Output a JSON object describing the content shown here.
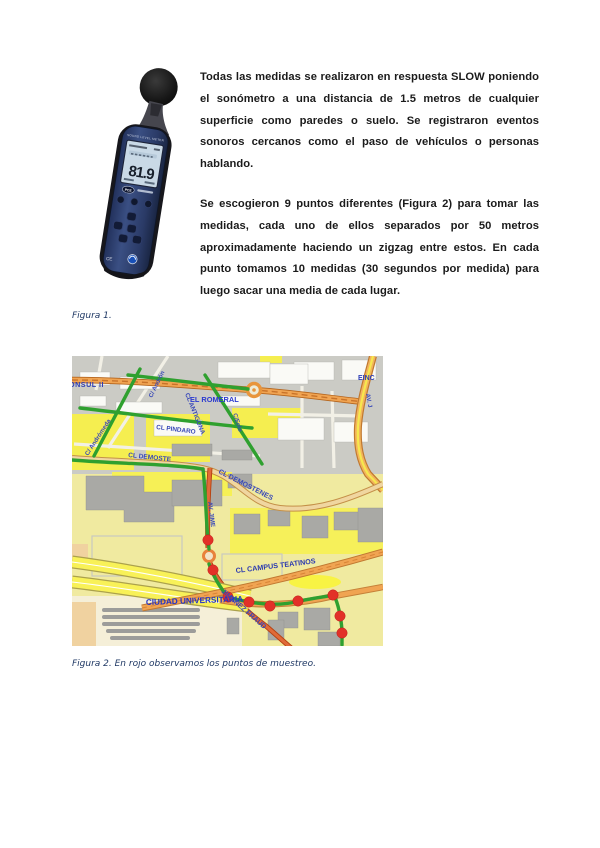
{
  "document": {
    "paragraph1": "Todas las medidas se realizaron en respuesta SLOW poniendo el sonómetro a una distancia de 1.5 metros de cualquier superficie como paredes o suelo. Se registraron eventos sonoros cercanos como el paso de vehículos o personas hablando.",
    "paragraph2": "Se escogieron 9 puntos diferentes (Figura 2) para tomar las medidas, cada uno de ellos separados por 50 metros aproximadamente haciendo un zigzag entre estos. En cada punto tomamos 10 medidas (30 segundos por medida) para luego sacar una media de cada lugar.",
    "figure1_caption": "Figura 1.",
    "figure2_caption": "Figura 2. En rojo observamos los puntos de muestreo."
  },
  "meter": {
    "header_label": "SOUND LEVEL METER",
    "display_value": "81.9",
    "brand_logo": "PCE",
    "ce_mark": "CE"
  },
  "map": {
    "street_labels": {
      "consul": "ONSUL II",
      "andron": "C/ Andrón",
      "andromeda": "C/ Andrómeda",
      "pindaro": "CL PINDARO",
      "antigona": "CL ANTIGONA",
      "romeral": "EL ROMERAL",
      "eolo": "C/Eolo",
      "einc": "EINC",
      "av_j": "AV. J",
      "demoste": "CL DEMOSTE",
      "demostenes": "CL DEMOSTENES",
      "av_jime": "AV. JIME",
      "campus_teatinos": "CL CAMPUS TEATINOS",
      "ciudad_universitaria": "CIUDAD UNIVERSITARIA",
      "jimenez_fraud": "JIMENEZ FRAUD"
    },
    "sample_points": [
      {
        "x": 136,
        "y": 184
      },
      {
        "x": 141,
        "y": 214
      },
      {
        "x": 156,
        "y": 241
      },
      {
        "x": 177,
        "y": 246
      },
      {
        "x": 198,
        "y": 250
      },
      {
        "x": 226,
        "y": 245
      },
      {
        "x": 261,
        "y": 239
      },
      {
        "x": 268,
        "y": 260
      },
      {
        "x": 270,
        "y": 277
      }
    ],
    "colors": {
      "route": "#2fa02f",
      "sample_point": "#e23128",
      "road_orange": "#f0a452",
      "label_blue": "#3848b8"
    }
  }
}
